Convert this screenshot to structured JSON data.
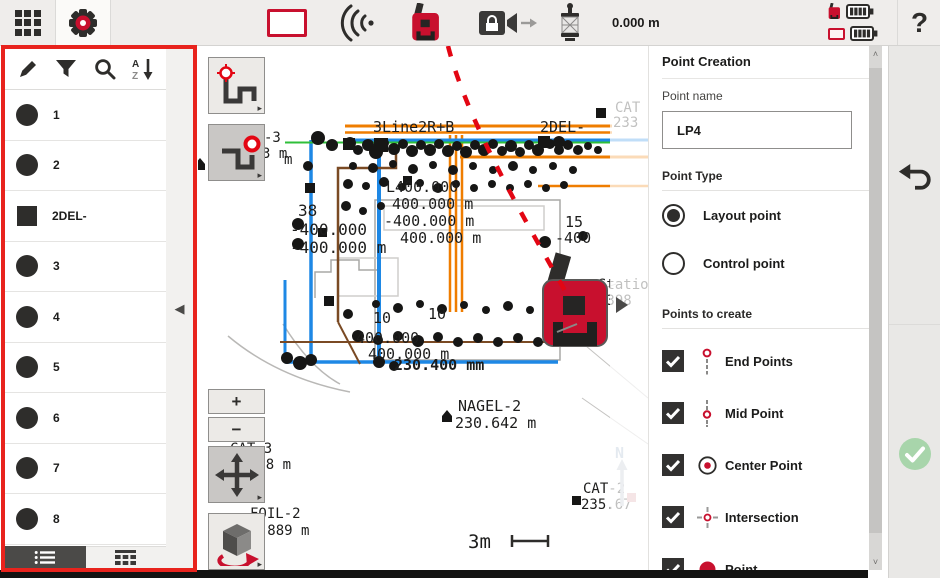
{
  "topbar": {
    "measurement": "0.000 m",
    "help_label": "?",
    "icons": {
      "menu": "grid-icon",
      "settings": "gear-icon",
      "layout": "rectangle-icon",
      "signal": "radio-waves-icon",
      "instrument": "total-station-icon",
      "lock_audio": "lock-speaker-icon",
      "prism": "prism-pole-icon",
      "status": [
        "instrument-battery-full",
        "controller-battery-full"
      ]
    },
    "accent_red": "#c8102e"
  },
  "sidebar": {
    "toolbar_icons": [
      "pencil-icon",
      "filter-icon",
      "search-icon",
      "sort-az-icon"
    ],
    "items": [
      {
        "label": "1",
        "shape": "circle"
      },
      {
        "label": "2",
        "shape": "circle"
      },
      {
        "label": "2DEL-",
        "shape": "square"
      },
      {
        "label": "3",
        "shape": "circle"
      },
      {
        "label": "4",
        "shape": "circle"
      },
      {
        "label": "5",
        "shape": "circle"
      },
      {
        "label": "6",
        "shape": "circle"
      },
      {
        "label": "7",
        "shape": "circle"
      },
      {
        "label": "8",
        "shape": "circle"
      }
    ],
    "tabs": [
      {
        "icon": "list-view-icon",
        "active": true
      },
      {
        "icon": "table-view-icon",
        "active": false
      }
    ],
    "collapse_icon": "◀",
    "highlight_color": "#e8231d"
  },
  "map": {
    "expand_icon": "▶",
    "compass_label": "N",
    "zoom_in": "+",
    "zoom_out": "−",
    "labels": [
      {
        "text": "3Line2R+B"
      },
      {
        "text": "2DEL-"
      },
      {
        "text": "CAT"
      },
      {
        "text": "233"
      },
      {
        "text": "m"
      },
      {
        "text": "38"
      },
      {
        "text": "-400.000"
      },
      {
        "text": "-400.000 m"
      },
      {
        "text": "L400.000"
      },
      {
        "text": "400.000 m"
      },
      {
        "text": "-400.000 m"
      },
      {
        "text": "400.000 m"
      },
      {
        "text": "15"
      },
      {
        "text": "-400"
      },
      {
        "text": "10"
      },
      {
        "text": "10"
      },
      {
        "text": "400.000"
      },
      {
        "text": "400.000 m"
      },
      {
        "text": "230.400 mm"
      },
      {
        "text": "NAGEL-2"
      },
      {
        "text": "230.642 m"
      },
      {
        "text": "CAT-3"
      },
      {
        "text": "2.778 m"
      },
      {
        "text": "FOIL-2"
      },
      {
        "text": "33.889 m"
      },
      {
        "text": "CAT-2"
      },
      {
        "text": "235.67"
      },
      {
        "text": "Station"
      },
      {
        "text": "-398"
      },
      {
        "text": "3m"
      },
      {
        "text": "-3"
      },
      {
        "text": "3 m"
      }
    ],
    "line_colors": {
      "orange": "#ef7d00",
      "blue": "#1e88e5",
      "green": "#2fbf3a",
      "brown": "#7a4a24",
      "laser_red": "#e30613"
    }
  },
  "panel": {
    "title": "Point Creation",
    "point_name_label": "Point name",
    "point_name_value": "LP4",
    "point_type_label": "Point Type",
    "radios": [
      {
        "label": "Layout point",
        "selected": true
      },
      {
        "label": "Control point",
        "selected": false
      }
    ],
    "points_to_create_label": "Points to create",
    "checkboxes": [
      {
        "label": "End Points",
        "checked": true,
        "icon": "end-points-icon"
      },
      {
        "label": "Mid Point",
        "checked": true,
        "icon": "mid-point-icon"
      },
      {
        "label": "Center Point",
        "checked": true,
        "icon": "center-point-icon"
      },
      {
        "label": "Intersection",
        "checked": true,
        "icon": "intersection-icon"
      },
      {
        "label": "Point",
        "checked": true,
        "icon": "point-icon"
      }
    ]
  },
  "side_actions": {
    "undo": "undo-icon",
    "confirm": "check-circle-icon"
  }
}
